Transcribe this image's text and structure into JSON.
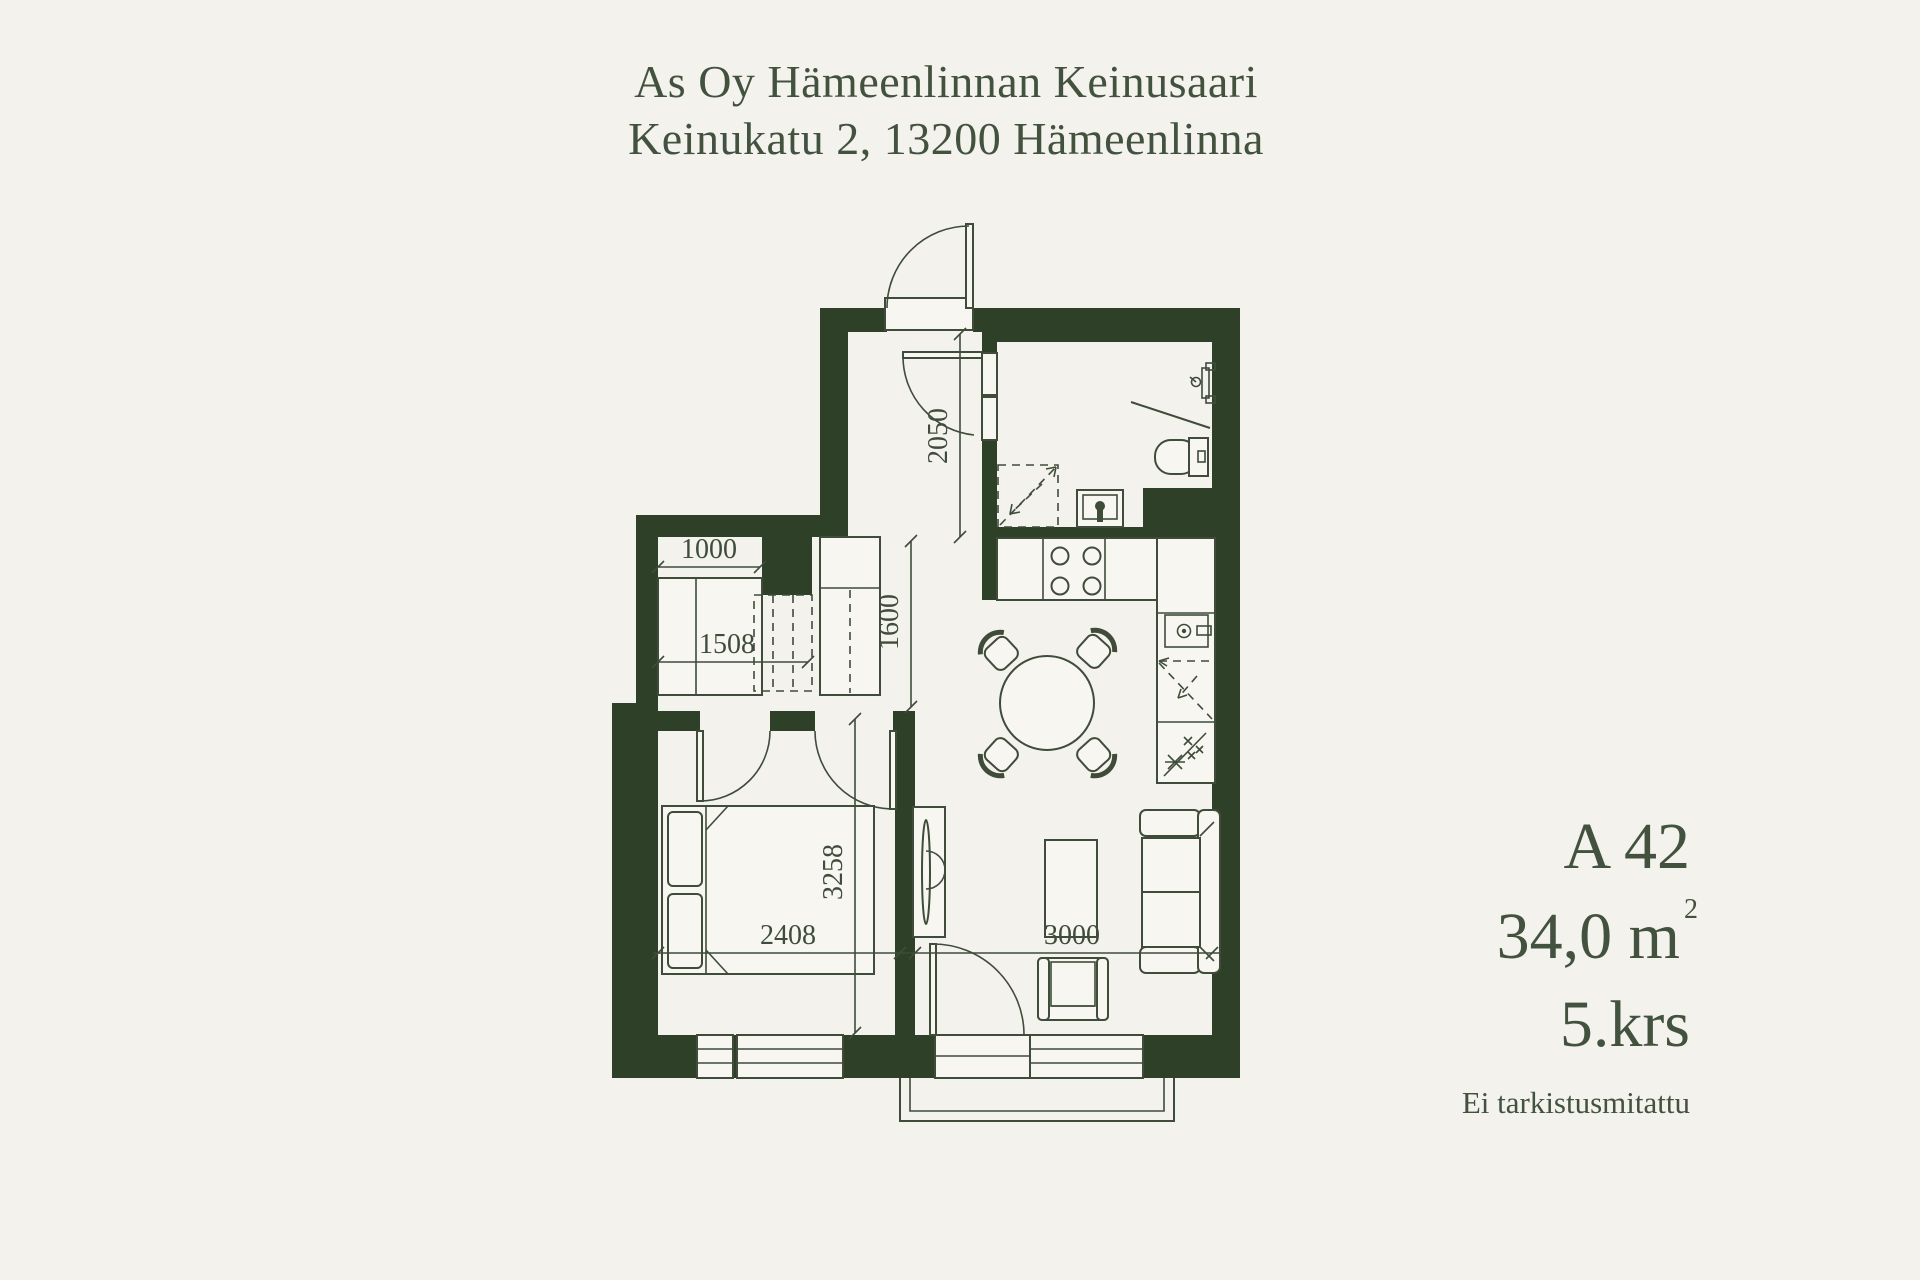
{
  "header": {
    "line1": "As Oy Hämeenlinnan Keinusaari",
    "line2": "Keinukatu 2, 13200 Hämeenlinna"
  },
  "apartment_info": {
    "unit": "A 42",
    "area_value": "34,0 m",
    "area_superscript": "2",
    "floor": "5.krs",
    "note": "Ei tarkistusmitattu"
  },
  "dimensions": {
    "hallway_length": "2050",
    "nook_height": "1600",
    "closet_width": "1000",
    "closet_depth": "1508",
    "bedroom_length": "3258",
    "bedroom_width": "2408",
    "living_width": "3000"
  },
  "colors": {
    "background": "#f3f2ec",
    "wall": "#2e4128",
    "line": "#3f4c3a",
    "furniture_fill": "#f7f6f1",
    "text": "#43523f"
  }
}
